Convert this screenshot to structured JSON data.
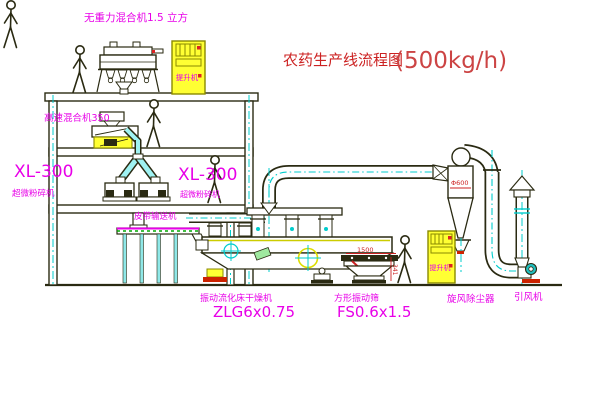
{
  "title": {
    "name": "农药生产线流程图",
    "capacity": "(500kg/h)"
  },
  "labels": {
    "mixer_top": "无重力混合机1.5 立方",
    "mixer_mid": "高速混合机350",
    "crusher_left_model": "XL-300",
    "crusher_left_name": "超微粉碎机",
    "crusher_right_model": "XL-300",
    "crusher_right_name": "超微粉碎机",
    "conveyor": "皮带输送机",
    "dryer_name": "振动流化床干燥机",
    "dryer_model": "ZLG6x0.75",
    "screen_name": "方形振动筛",
    "screen_model": "FS0.6x1.5",
    "cyclone": "旋风除尘器",
    "fan": "引风机",
    "elevator_top": "提升机",
    "elevator_bottom": "提升机"
  },
  "dimensions": {
    "cyclone_diameter": "Φ600",
    "screen_length": "1500",
    "screen_height": "341"
  },
  "colors": {
    "label_magenta": "#e800e8",
    "title_red": "#cc3333",
    "dimension_red": "#cc2222",
    "pipe_cyan": "#00cccc",
    "highlight_yellow": "#ffff33",
    "line_dark": "#2a2a12",
    "belt_green": "#00aa00"
  }
}
